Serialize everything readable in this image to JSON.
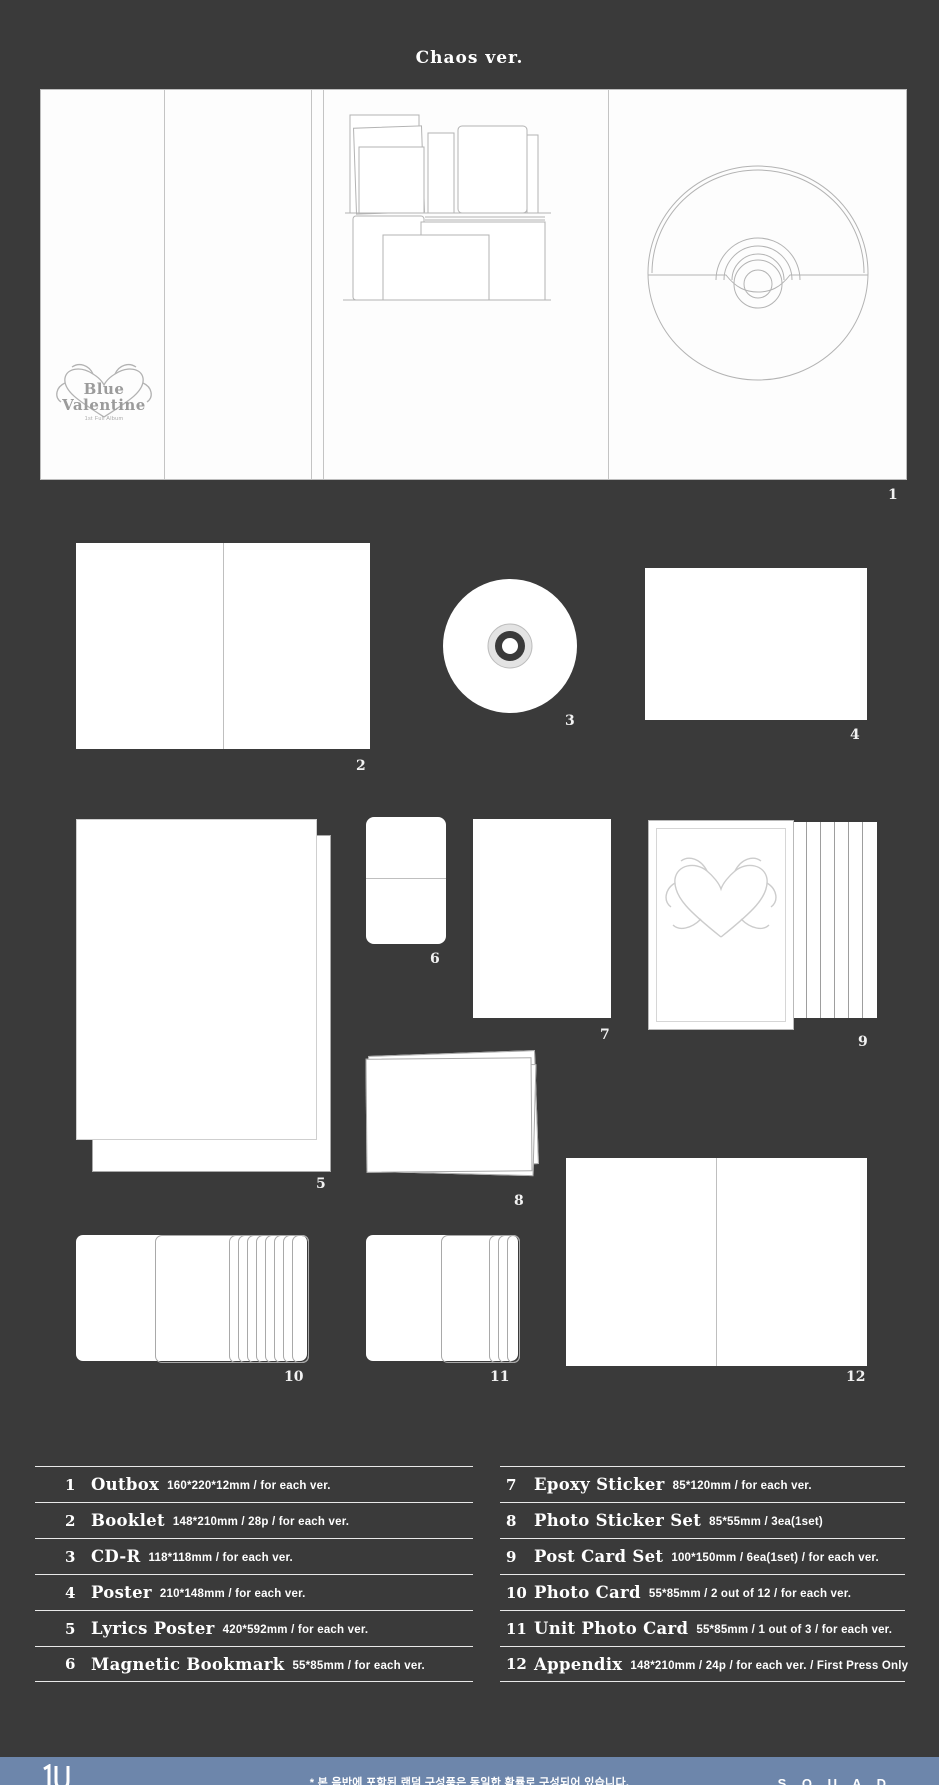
{
  "page": {
    "title": "Chaos ver."
  },
  "outbox": {
    "logo_line1": "Blue",
    "logo_line2": "Valentine",
    "logo_subtext": "1st Full Album"
  },
  "accent_colors": {
    "background": "#3a3a3a",
    "footer_bar": "#6d86ab",
    "panel_white": "#ffffff"
  },
  "items": [
    {
      "num": "1",
      "name": "Outbox",
      "spec": "160*220*12mm / for each ver."
    },
    {
      "num": "2",
      "name": "Booklet",
      "spec": "148*210mm / 28p / for each ver."
    },
    {
      "num": "3",
      "name": "CD-R",
      "spec": "118*118mm / for each ver."
    },
    {
      "num": "4",
      "name": "Poster",
      "spec": "210*148mm / for each ver."
    },
    {
      "num": "5",
      "name": "Lyrics Poster",
      "spec": "420*592mm / for each ver."
    },
    {
      "num": "6",
      "name": "Magnetic Bookmark",
      "spec": "55*85mm / for each ver."
    },
    {
      "num": "7",
      "name": "Epoxy Sticker",
      "spec": "85*120mm / for each ver."
    },
    {
      "num": "8",
      "name": "Photo Sticker Set",
      "spec": "85*55mm / 3ea(1set)"
    },
    {
      "num": "9",
      "name": "Post Card Set",
      "spec": "100*150mm / 6ea(1set) / for each ver."
    },
    {
      "num": "10",
      "name": "Photo Card",
      "spec": "55*85mm / 2 out of 12 / for each ver."
    },
    {
      "num": "11",
      "name": "Unit Photo Card",
      "spec": "55*85mm / 1 out of 3 / for each ver."
    },
    {
      "num": "12",
      "name": "Appendix",
      "spec": "148*210mm / 24p / for each ver. / First Press Only"
    }
  ],
  "footer": {
    "note": "* 본 음반에 포함된 랜덤 구성품은 동일한 확률로 구성되어 있습니다.",
    "brand": "S Q U A D"
  }
}
